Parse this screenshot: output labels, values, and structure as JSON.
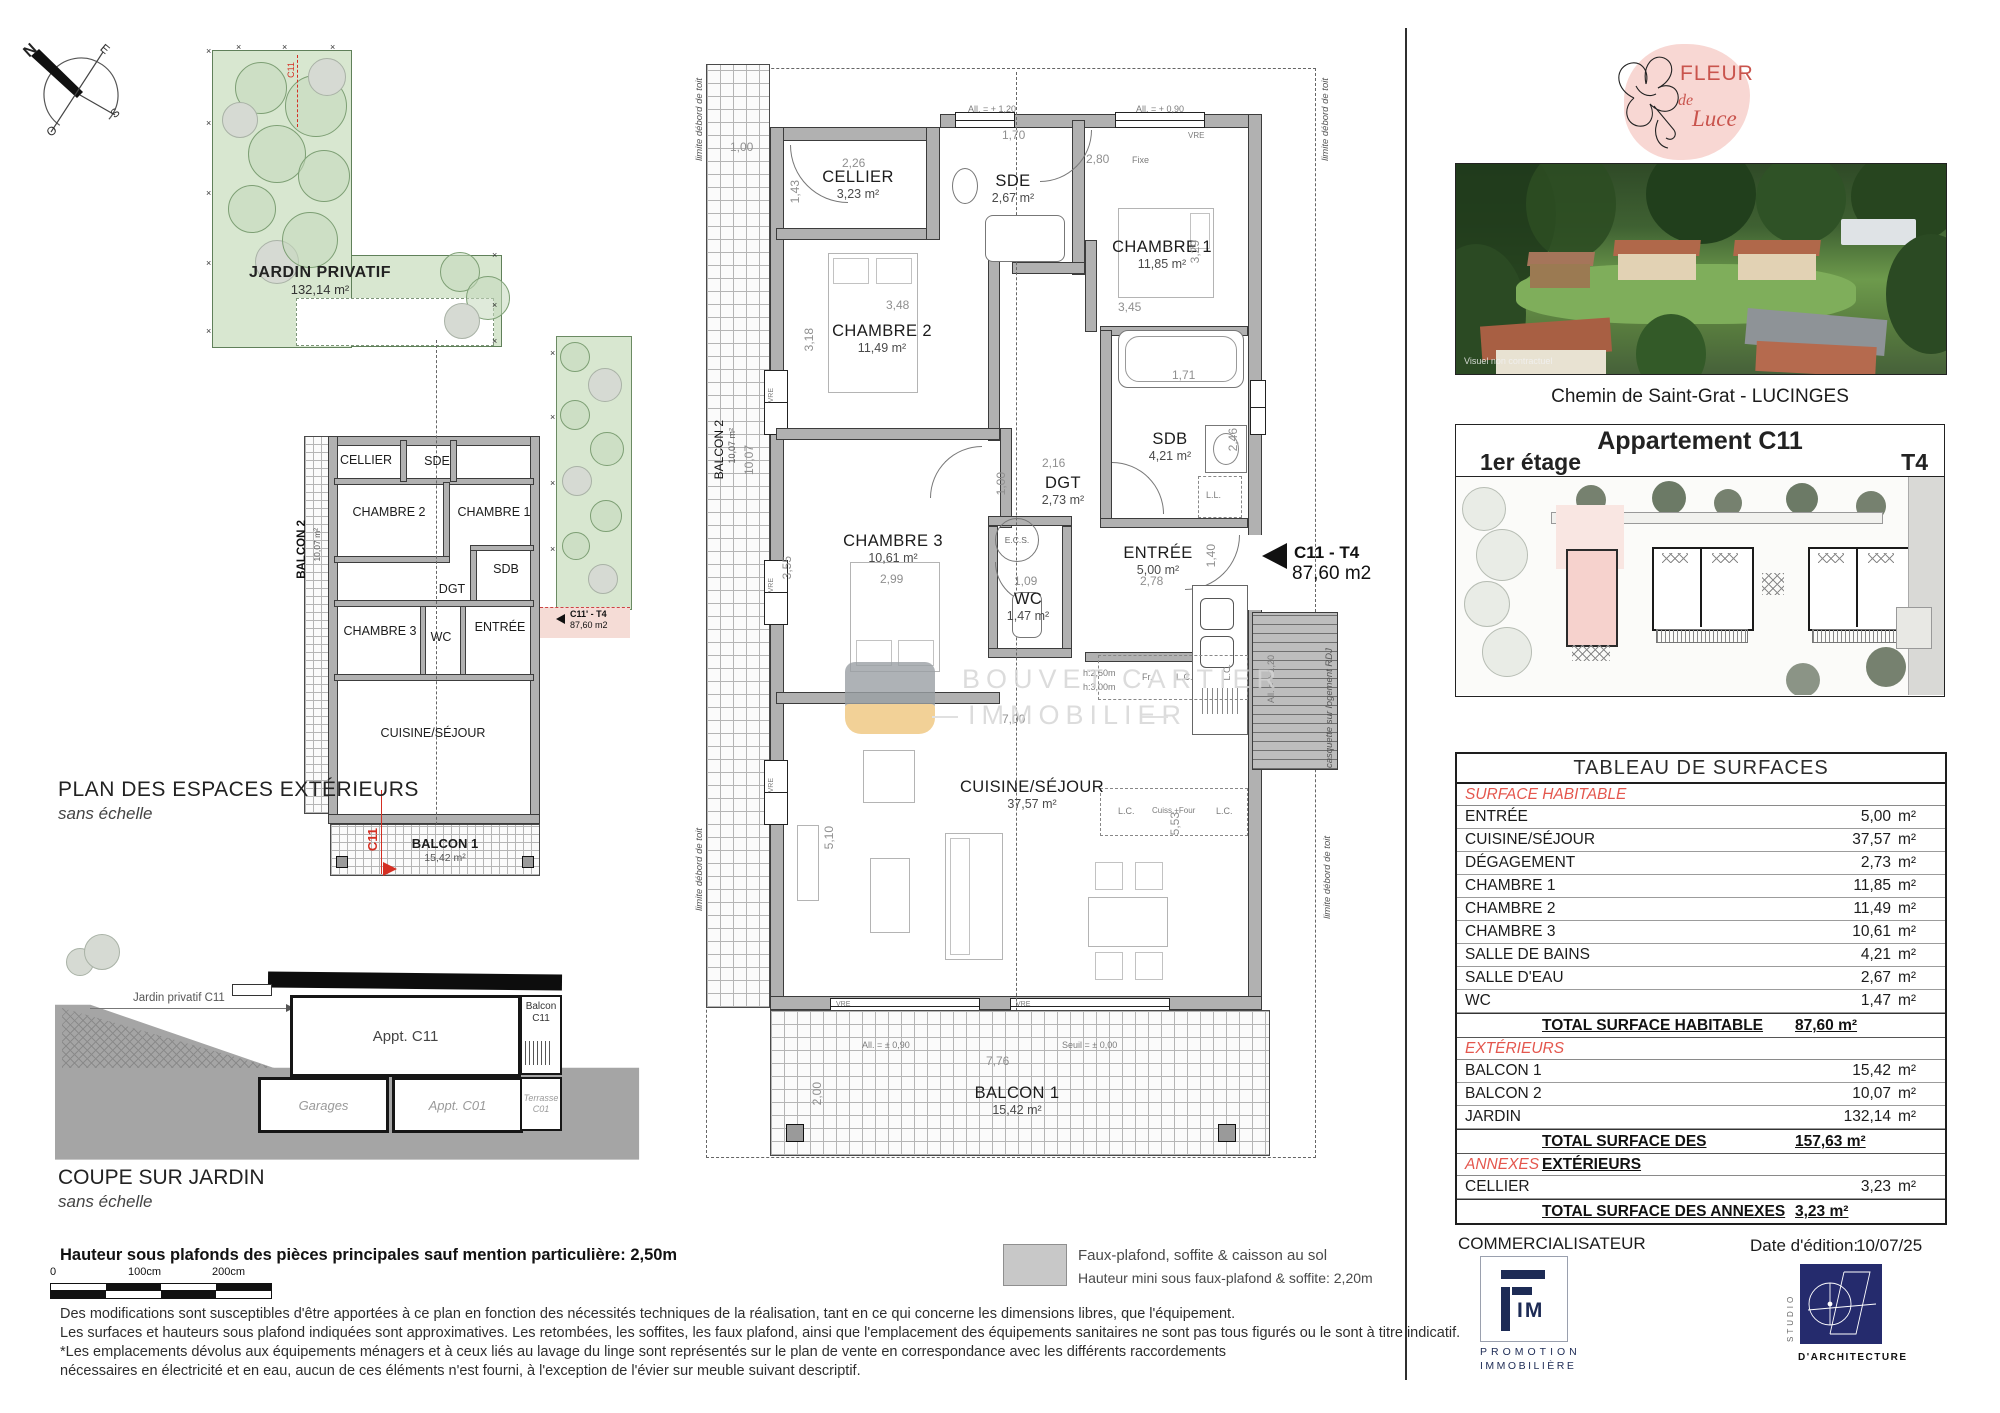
{
  "compass": {
    "n": "N",
    "e": "E",
    "s": "S",
    "o": "O"
  },
  "left_plan": {
    "title": "PLAN DES ESPACES EXTÉRIEURS",
    "subtitle": "sans échelle",
    "jardin": {
      "label": "JARDIN PRIVATIF",
      "area": "132,14 m²"
    },
    "rooms": {
      "cellier": "CELLIER",
      "sde": "SDE",
      "chambre2": "CHAMBRE 2",
      "chambre1": "CHAMBRE 1",
      "sdb": "SDB",
      "dgt": "DGT",
      "chambre3": "CHAMBRE 3",
      "wc": "WC",
      "entree": "ENTRÉE",
      "cuisine": "CUISINE/SÉJOUR"
    },
    "balcon1": {
      "label": "BALCON 1",
      "area": "15,42 m²"
    },
    "balcon2": {
      "label": "BALCON 2",
      "area": "10,07 m²"
    },
    "marker": "C11",
    "unit_tag": {
      "code": "C11' - T4",
      "area": "87,60 m2"
    }
  },
  "coupe": {
    "title": "COUPE SUR JARDIN",
    "subtitle": "sans échelle",
    "jardin_label": "Jardin privatif C11",
    "appt_c11": "Appt. C11",
    "balcon_c11": "Balcon C11",
    "garages": "Garages",
    "appt_c01": "Appt. C01",
    "terrasse_c01": "Terrasse C01"
  },
  "main_plan": {
    "limit_label": "limite débord de toit",
    "casquette_label": "casquette sur logement RDJ",
    "unit_arrow": {
      "code": "C11 - T4",
      "area": "87,60 m2"
    },
    "rooms": {
      "cellier": {
        "name": "CELLIER",
        "area": "3,23 m²"
      },
      "sde": {
        "name": "SDE",
        "area": "2,67 m²"
      },
      "chambre1": {
        "name": "CHAMBRE 1",
        "area": "11,85 m²"
      },
      "chambre2": {
        "name": "CHAMBRE 2",
        "area": "11,49 m²"
      },
      "chambre3": {
        "name": "CHAMBRE 3",
        "area": "10,61 m²"
      },
      "sdb": {
        "name": "SDB",
        "area": "4,21 m²"
      },
      "dgt": {
        "name": "DGT",
        "area": "2,73 m²"
      },
      "wc": {
        "name": "WC",
        "area": "1,47 m²"
      },
      "entree": {
        "name": "ENTRÉE",
        "area": "5,00 m²"
      },
      "cuisine": {
        "name": "CUISINE/SÉJOUR",
        "area": "37,57 m²"
      },
      "balcon1": {
        "name": "BALCON 1",
        "area": "15,42 m²"
      },
      "balcon2": {
        "name": "BALCON 2",
        "area": "10,07 m²"
      }
    },
    "dims": {
      "d100a": "1,00",
      "d226": "2,26",
      "d143": "1,43",
      "d170": "1,70",
      "d280": "2,80",
      "d348": "3,48",
      "d318": "3,18",
      "d345": "3,45",
      "d329": "3,29",
      "d171": "1,71",
      "d246": "2,46",
      "d216": "2,16",
      "d100b": "1,00",
      "d299": "2,99",
      "d355": "3,55",
      "d109": "1,09",
      "d278": "2,78",
      "d140": "1,40",
      "d700": "7,00",
      "d510": "5,10",
      "d553": "5,53",
      "d776": "7,76",
      "d200": "2,00",
      "d1007": "10,07"
    },
    "ann": {
      "all120": "All. = + 1,20",
      "all090": "All. = + 0,90",
      "all090b": "All. = ± 0,90",
      "seuil": "Seuil = ± 0,00",
      "fixe": "Fixe",
      "vre": "VRE",
      "ecs": "E.C.S.",
      "ll": "L.L.",
      "fr": "Fr.",
      "lc": "L.C.",
      "cuiss": "Cuiss.+Four",
      "h250": "h:2,50m",
      "h300": "h:3,00m"
    }
  },
  "watermark": {
    "line1": "BOUVET CARTIER",
    "line2": "IMMOBILIER"
  },
  "brand": {
    "logo": {
      "w1": "FLEUR",
      "w2": "de",
      "w3": "Luce"
    },
    "photo_caption": "Visuel non contractuel",
    "address": "Chemin de Saint-Grat - LUCINGES"
  },
  "apartment": {
    "title": "Appartement C11",
    "floor": "1er étage",
    "type": "T4"
  },
  "table": {
    "title": "TABLEAU DE SURFACES",
    "unit": "m²",
    "sections": [
      {
        "header": "SURFACE HABITABLE",
        "rows": [
          [
            "ENTRÉE",
            "5,00"
          ],
          [
            "CUISINE/SÉJOUR",
            "37,57"
          ],
          [
            "DÉGAGEMENT",
            "2,73"
          ],
          [
            "CHAMBRE 1",
            "11,85"
          ],
          [
            "CHAMBRE 2",
            "11,49"
          ],
          [
            "CHAMBRE 3",
            "10,61"
          ],
          [
            "SALLE DE BAINS",
            "4,21"
          ],
          [
            "SALLE D'EAU",
            "2,67"
          ],
          [
            "WC",
            "1,47"
          ]
        ],
        "total_label": "TOTAL SURFACE HABITABLE",
        "total_value": "87,60 m²"
      },
      {
        "header": "EXTÉRIEURS",
        "rows": [
          [
            "BALCON 1",
            "15,42"
          ],
          [
            "BALCON 2",
            "10,07"
          ],
          [
            "JARDIN",
            "132,14"
          ]
        ],
        "total_label": "TOTAL SURFACE DES EXTÉRIEURS",
        "total_value": "157,63 m²"
      },
      {
        "header": "ANNEXES",
        "rows": [
          [
            "CELLIER",
            "3,23"
          ]
        ],
        "total_label": "TOTAL SURFACE DES ANNEXES",
        "total_value": "3,23 m²"
      }
    ]
  },
  "footer": {
    "ceiling_note": "Hauteur sous plafonds des pièces principales sauf mention particulière: 2,50m",
    "scale": [
      "0",
      "100cm",
      "200cm"
    ],
    "legend1": "Faux-plafond, soffite & caisson au sol",
    "legend2": "Hauteur mini sous faux-plafond & soffite: 2,20m",
    "paragraph": [
      "Des modifications sont susceptibles d'être apportées à ce plan en fonction des nécessités techniques de la réalisation, tant en ce qui concerne les dimensions libres, que l'équipement.",
      "Les surfaces et hauteurs sous plafond indiquées sont approximatives. Les retombées, les soffites, les faux plafond, ainsi que l'emplacement des équipements sanitaires ne sont pas tous figurés ou le sont à titre indicatif.",
      "*Les emplacements dévolus aux équipements ménagers et à ceux liés au lavage du linge sont représentés sur le plan de vente en correspondance avec les différents raccordements",
      "nécessaires en électricité et en eau, aucun de ces éléments n'est fourni, à l'exception de l'évier sur meuble suivant descriptif."
    ],
    "commercialisateur": "COMMERCIALISATEUR",
    "fim": {
      "im": "IM",
      "sub1": "PROMOTION",
      "sub2": "IMMOBILIÈRE"
    },
    "edition_label": "Date d'édition:",
    "edition_value": "10/07/25",
    "studio_vertical": "STUDIO",
    "studio_label": "D'ARCHITECTURE"
  }
}
